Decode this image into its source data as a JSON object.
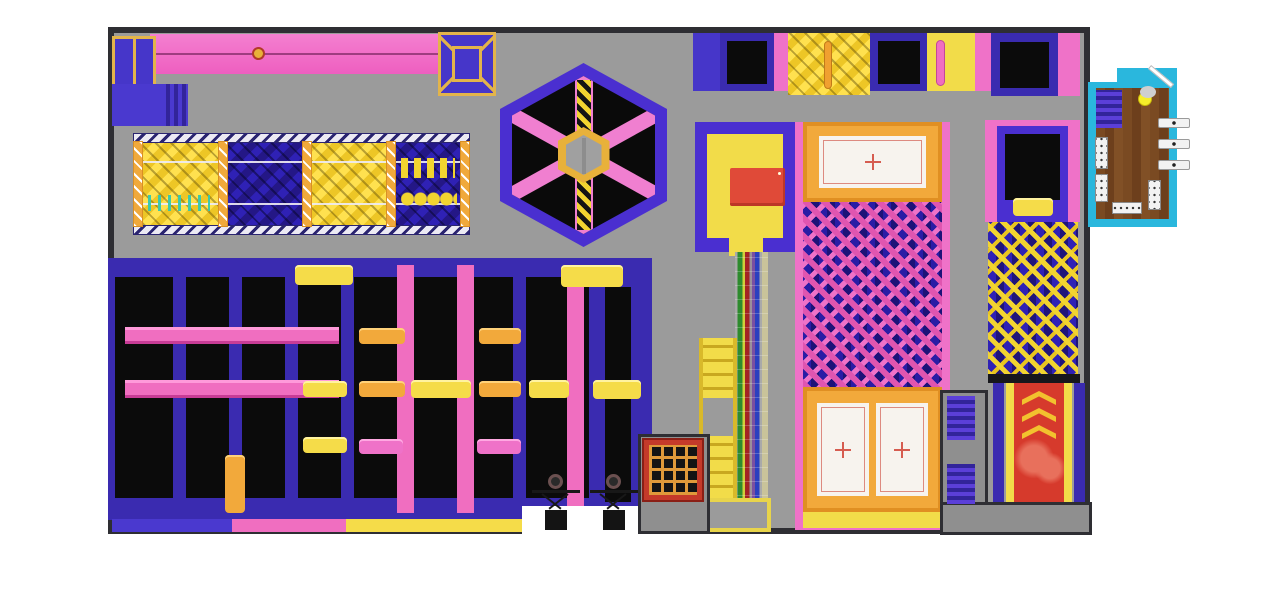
{
  "meta": {
    "canvas_width": 1280,
    "canvas_height": 597,
    "view": "top-down-floor-plan-render"
  },
  "palette": {
    "floor": "#9b9b9b",
    "wall": "#2e2e33",
    "purple": "#3a2bb0",
    "indigo": "#4636c9",
    "pink": "#f06ec0",
    "magenta": "#e7489f",
    "yellow": "#f5dc49",
    "gold": "#e3b44a",
    "orange": "#f2a93b",
    "red": "#d63a2c",
    "red_mat": "#e04a38",
    "teal": "#2ab7dd",
    "wood": "#7a4a22",
    "black_bed": "#0b0b0b",
    "blue_foam": "#2a1ca5",
    "white_panel": "#f7f3ee"
  },
  "zones": {
    "zipline": {
      "label": "zipline-track"
    },
    "foam_pit_row": {
      "label": "foam-cube-pits-with-trusses",
      "section_fills": [
        "yellow",
        "blue",
        "yellow",
        "blue"
      ]
    },
    "sweeper": {
      "label": "hexagon-sweeper-arena"
    },
    "court": {
      "label": "main-trampoline-court"
    },
    "platform": {
      "label": "performance-platform-with-red-mat"
    },
    "rainbow_track": {
      "label": "rainbow-climb-track"
    },
    "ladder": {
      "label": "access-ladder"
    },
    "climb_grid": {
      "label": "red-climbing-net"
    },
    "airbag_pit": {
      "label": "pink-blue-foam-pit-with-airbag-panels",
      "panel_count": 3
    },
    "launch_pit": {
      "label": "launch-trampoline-foam-pit"
    },
    "slide": {
      "label": "red-slide",
      "chevrons": 3
    },
    "wall_row": {
      "label": "wall-trampoline-row"
    },
    "reception": {
      "label": "reception-room",
      "tabs": 3,
      "benches": 4
    },
    "entrance": {
      "label": "entrance-gap",
      "wheel_stands": 2
    }
  }
}
